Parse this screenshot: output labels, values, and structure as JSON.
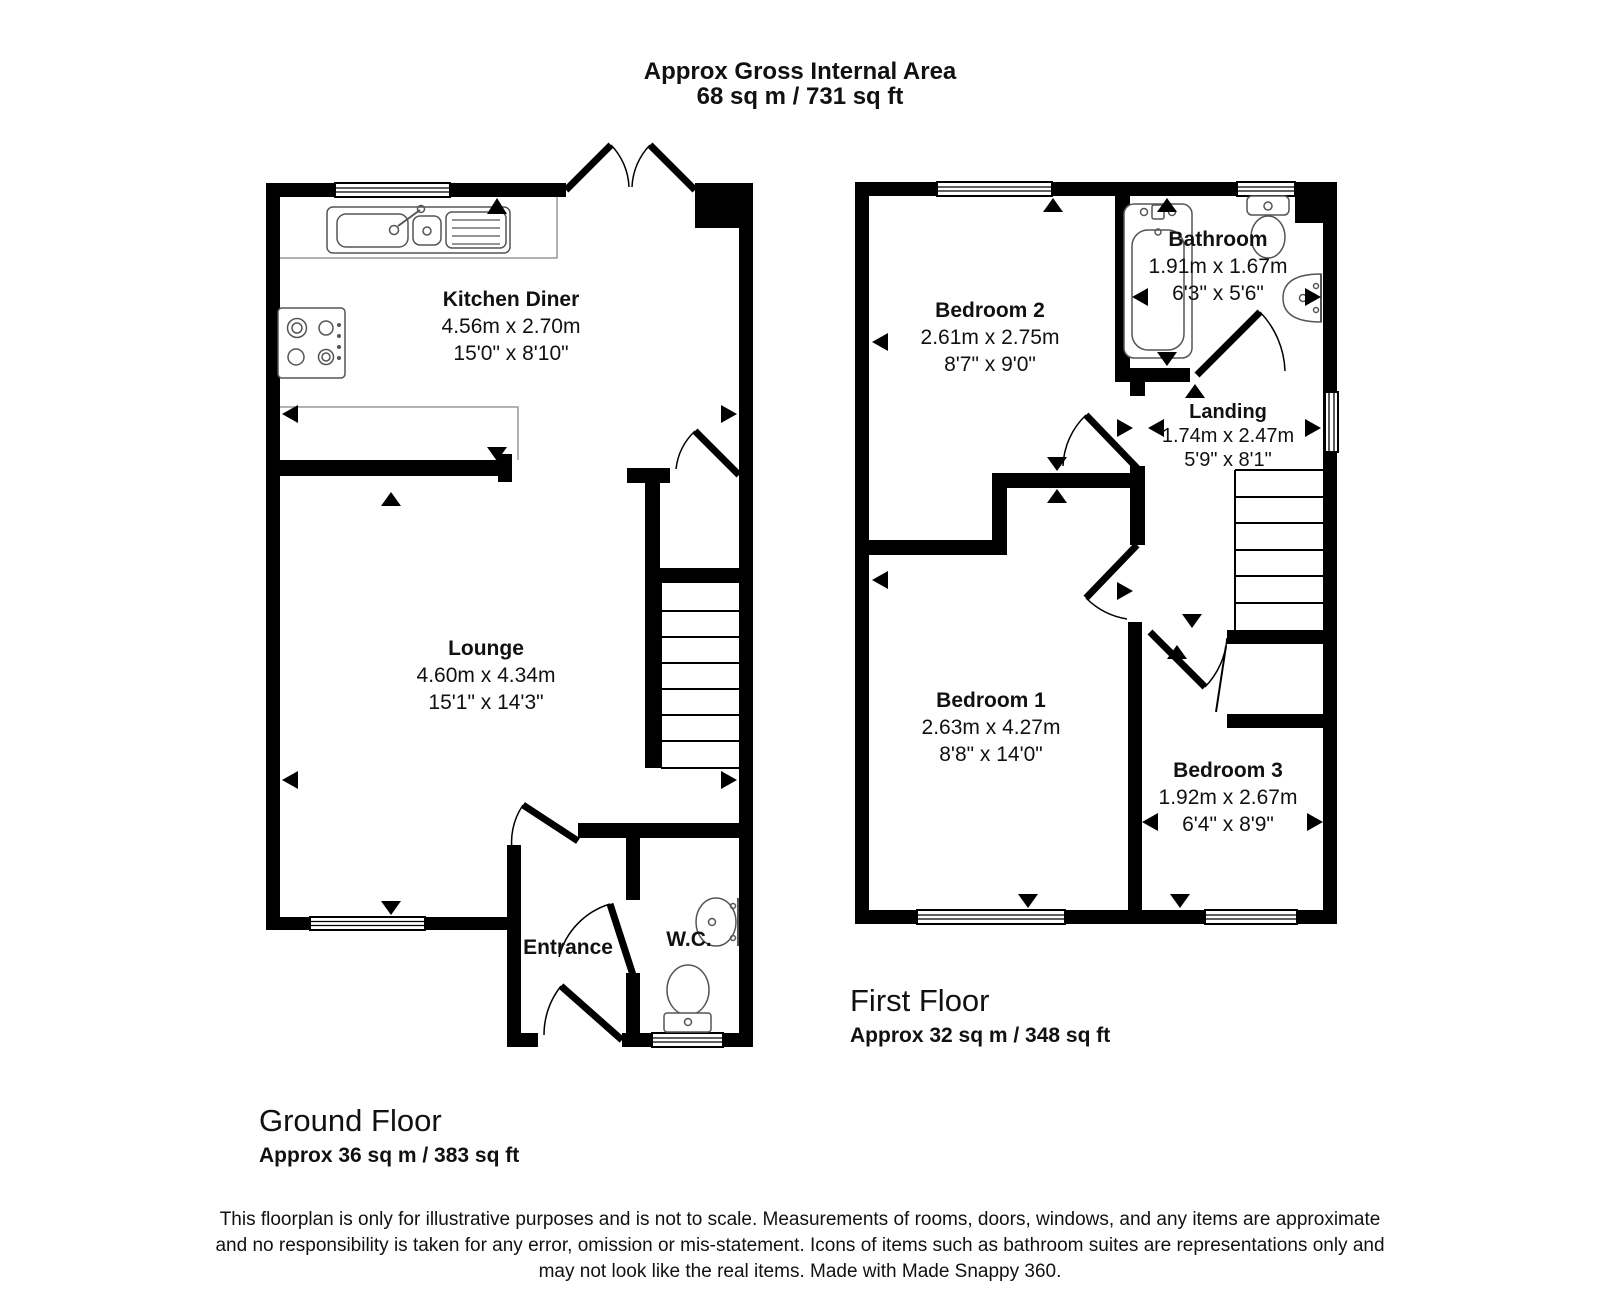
{
  "title": {
    "line1": "Approx Gross Internal Area",
    "line2": "68 sq m / 731 sq ft"
  },
  "ground_floor": {
    "floor_label": "Ground Floor",
    "floor_area": "Approx 36 sq m / 383 sq ft",
    "rooms": {
      "kitchen_diner": {
        "name": "Kitchen Diner",
        "metric": "4.56m x 2.70m",
        "imperial": "15'0\" x 8'10\""
      },
      "lounge": {
        "name": "Lounge",
        "metric": "4.60m x 4.34m",
        "imperial": "15'1\" x 14'3\""
      },
      "entrance": {
        "name": "Entrance"
      },
      "wc": {
        "name": "W.C."
      }
    }
  },
  "first_floor": {
    "floor_label": "First Floor",
    "floor_area": "Approx 32 sq m / 348 sq ft",
    "rooms": {
      "bedroom2": {
        "name": "Bedroom 2",
        "metric": "2.61m x 2.75m",
        "imperial": "8'7\" x 9'0\""
      },
      "bathroom": {
        "name": "Bathroom",
        "metric": "1.91m x 1.67m",
        "imperial": "6'3\" x 5'6\""
      },
      "landing": {
        "name": "Landing",
        "metric": "1.74m x 2.47m",
        "imperial": "5'9\" x 8'1\""
      },
      "bedroom1": {
        "name": "Bedroom 1",
        "metric": "2.63m x 4.27m",
        "imperial": "8'8\" x 14'0\""
      },
      "bedroom3": {
        "name": "Bedroom 3",
        "metric": "1.92m x 2.67m",
        "imperial": "6'4\" x 8'9\""
      }
    }
  },
  "disclaimer": {
    "line1": "This floorplan is only for illustrative purposes and is not to scale. Measurements of rooms, doors, windows, and any items are approximate",
    "line2": "and no responsibility is taken for any error, omission or mis-statement. Icons of items such as bathroom suites are representations only and",
    "line3": "may not look like the real items. Made with Made Snappy 360."
  },
  "colors": {
    "wall": "#000000",
    "fixture_outline": "#555555",
    "counter_line": "#999999",
    "background": "#ffffff"
  }
}
